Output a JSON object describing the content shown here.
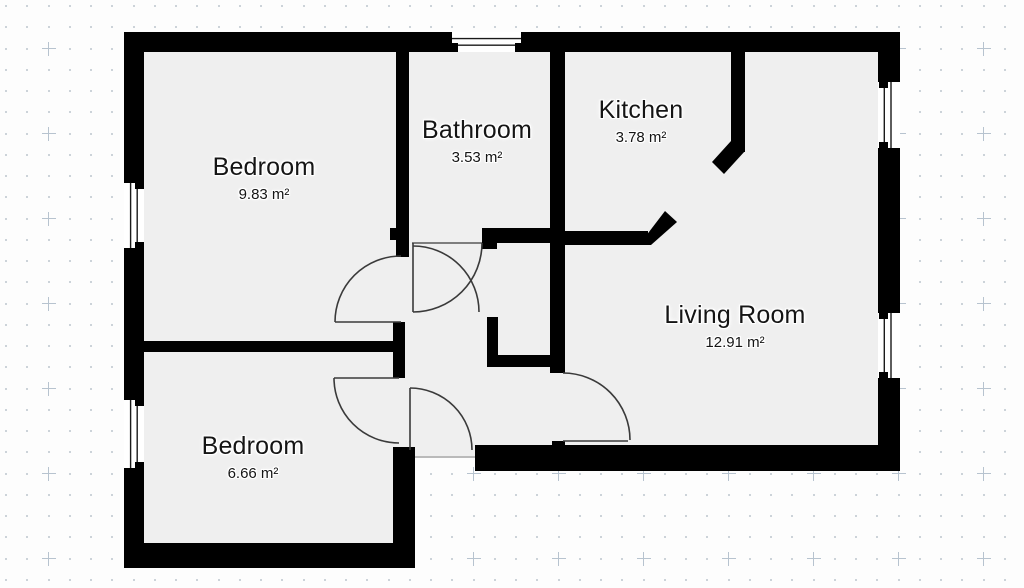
{
  "title": "Apartment floor plan",
  "rooms": [
    {
      "id": "bedroom-1",
      "name": "Bedroom",
      "area": "9.83 m²"
    },
    {
      "id": "bathroom",
      "name": "Bathroom",
      "area": "3.53 m²"
    },
    {
      "id": "kitchen",
      "name": "Kitchen",
      "area": "3.78 m²"
    },
    {
      "id": "living-room",
      "name": "Living Room",
      "area": "12.91 m²"
    },
    {
      "id": "bedroom-2",
      "name": "Bedroom",
      "area": "6.66 m²"
    }
  ],
  "counts": {
    "windows": 5,
    "doors": 5
  },
  "colors": {
    "wall": "#000000",
    "floor": "#efefef",
    "door_line": "#3a3a3a",
    "grid_dot": "#ccd3d9",
    "grid_cross": "#b7c3cf",
    "background": "#fdfdfd",
    "label_text": "#151515"
  }
}
